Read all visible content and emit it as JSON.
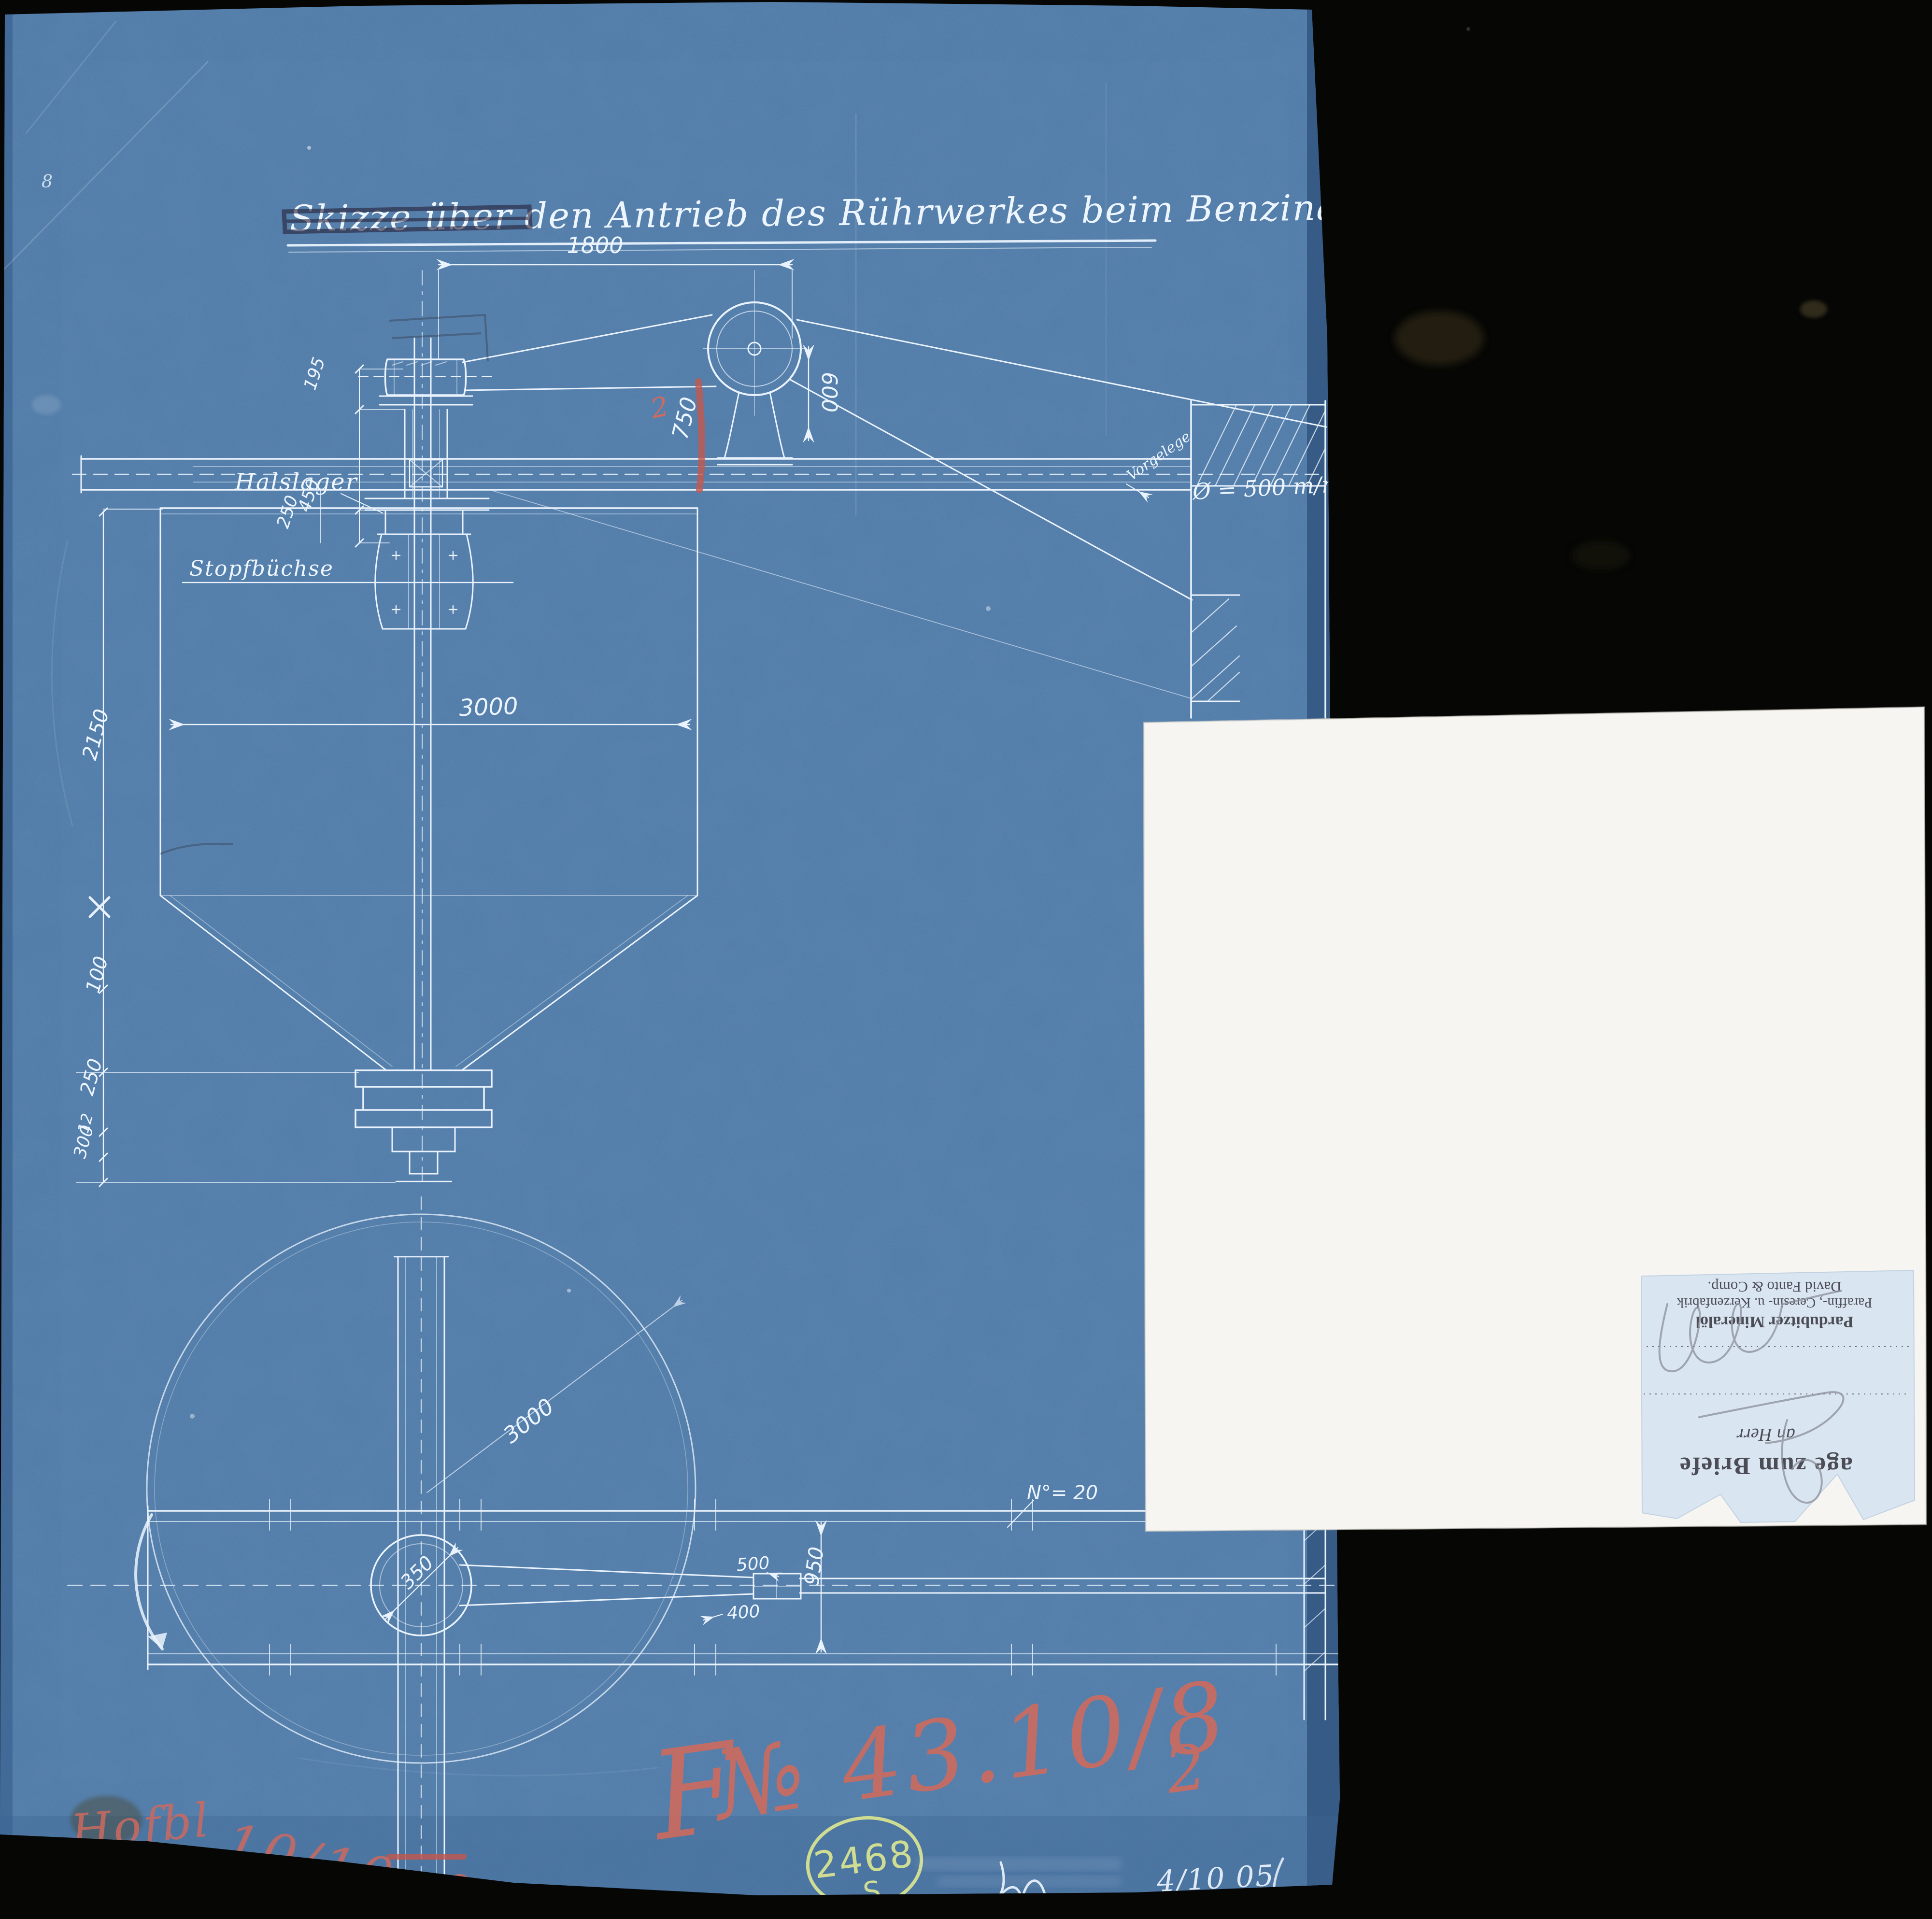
{
  "page": {
    "background": "#060605",
    "blueprint_paper_color": "#4d79a7",
    "white_paper_color": "#f6f5f1",
    "slip_color": "#d9e5f1",
    "line_ink_color": "#eaf3fd",
    "red_crayon_color": "#ce6a5f",
    "green_stamp_color": "#dbe692"
  },
  "blueprint": {
    "title": "Skizze über den Antrieb des Rührwerkes beim Benzinagitateur V.",
    "labels": {
      "halslager": "Halslager",
      "stopfbuechse": "Stopfbüchse",
      "vorgelege": "Vorgelege",
      "diameter": "Ø = 500 m/m",
      "profile": "N°= 20",
      "corner_mark": "8"
    },
    "dims": {
      "d1800": "1800",
      "d600": "600",
      "d195": "195",
      "d450": "450",
      "d250a": "250",
      "d750": "750",
      "d750sub": "2",
      "d2150": "2150",
      "d100": "100",
      "d250b": "250",
      "d12": "12",
      "d300": "300",
      "d3000elev": "3000",
      "d3000plan": "3000",
      "d350": "350",
      "d500": "500",
      "d400": "400",
      "d950": "950"
    }
  },
  "annotations": {
    "red_prefix": "F",
    "red_number": "№ 43.10/8",
    "red_sub": "2",
    "red_word": "Hofbl",
    "red_date": "10/10. 05",
    "stamp_number": "2468",
    "stamp_letter": "S",
    "signature_date": "4/10 05"
  },
  "slip": {
    "heading": "age zum Briefe",
    "salutation": "an Herr",
    "company1": "Pardubitzer Mineralöl",
    "company2": "Paraffin-, Ceresin- u. Kerzenfabrik",
    "company3": "David Fanto & Comp."
  }
}
